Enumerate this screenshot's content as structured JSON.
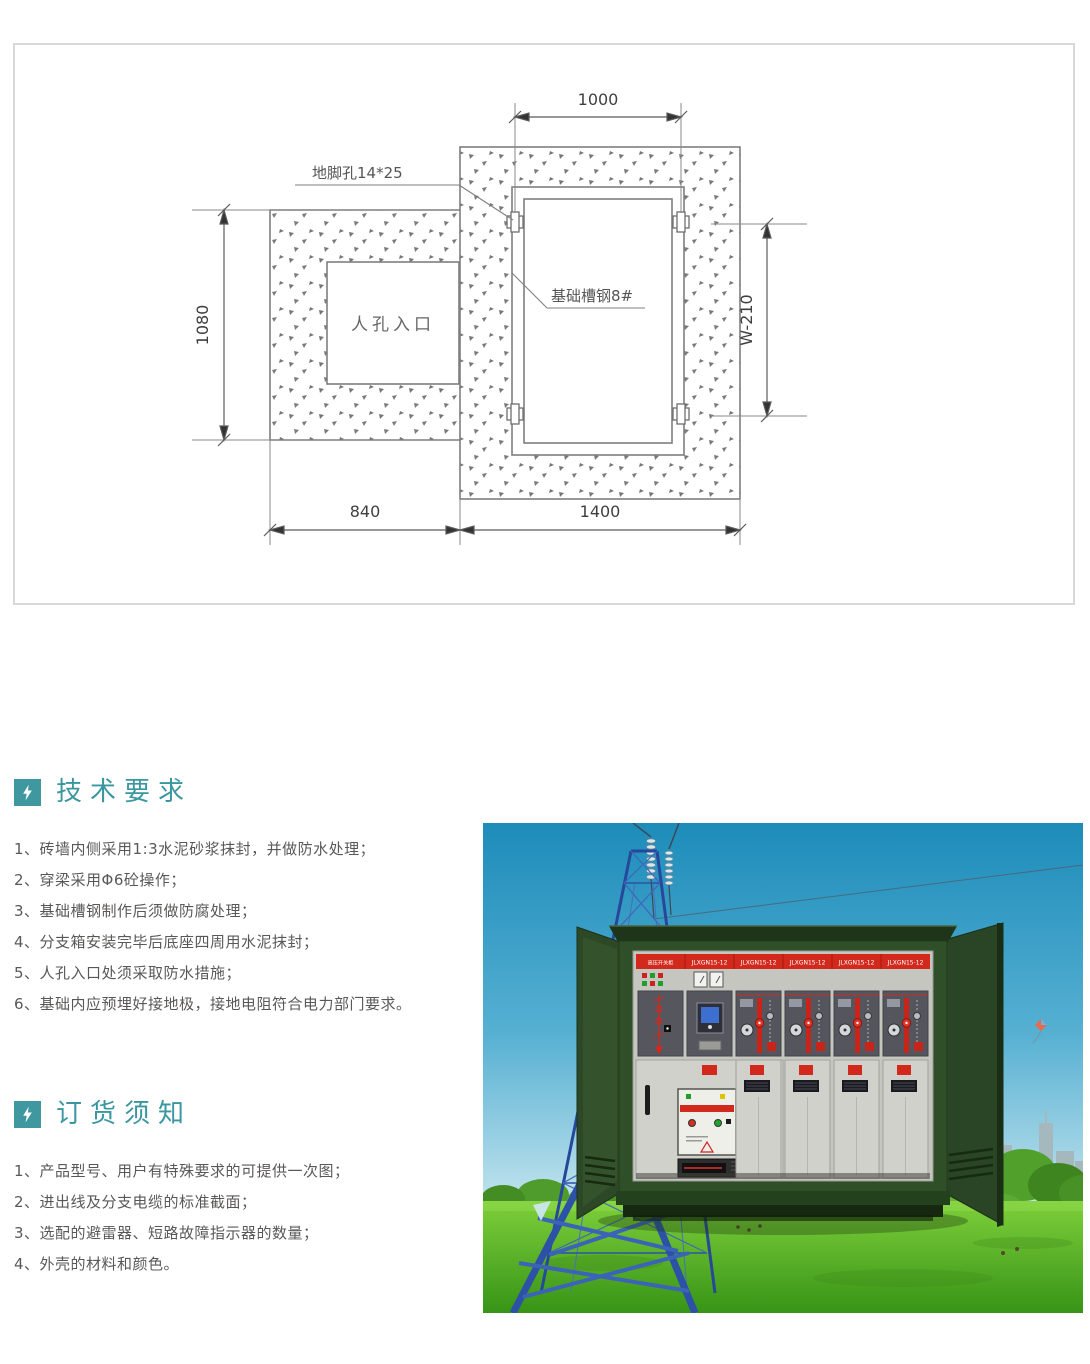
{
  "drawing": {
    "dim_top": "1000",
    "dim_left": "1080",
    "dim_right": "W-210",
    "dim_bottom_left": "840",
    "dim_bottom_right": "1400",
    "anchor_hole_label": "地脚孔14*25",
    "channel_steel_label": "基础槽钢8#",
    "manhole_label": "人孔入口"
  },
  "tech_requirements": {
    "title": "技术要求",
    "items": [
      "1、砖墙内侧采用1:3水泥砂浆抹封，并做防水处理；",
      "2、穿梁采用Φ6砼操作；",
      "3、基础槽钢制作后须做防腐处理；",
      "4、分支箱安装完毕后底座四周用水泥抹封；",
      "5、人孔入口处须采取防水措施；",
      "6、基础内应预埋好接地极，接地电阻符合电力部门要求。"
    ]
  },
  "order_notes": {
    "title": "订货须知",
    "items": [
      "1、产品型号、用户有特殊要求的可提供一次图；",
      "2、进出线及分支电缆的标准截面；",
      "3、选配的避雷器、短路故障指示器的数量；",
      "4、外壳的材料和颜色。"
    ]
  },
  "photo": {
    "cabinet_panel_labels": [
      "高压开关柜",
      "JLXGN15-12",
      "JLXGN15-12",
      "JLXGN15-12",
      "JLXGN15-12",
      "JLXGN15-12"
    ]
  },
  "colors": {
    "accent_teal": "#3f98a0",
    "panel_header_red": "#d2291c",
    "cabinet_green": "#2f4f29",
    "sky_blue": "#1d8cba",
    "grass_green": "#58b32c",
    "drawing_line_gray": "#7f7f7f"
  }
}
